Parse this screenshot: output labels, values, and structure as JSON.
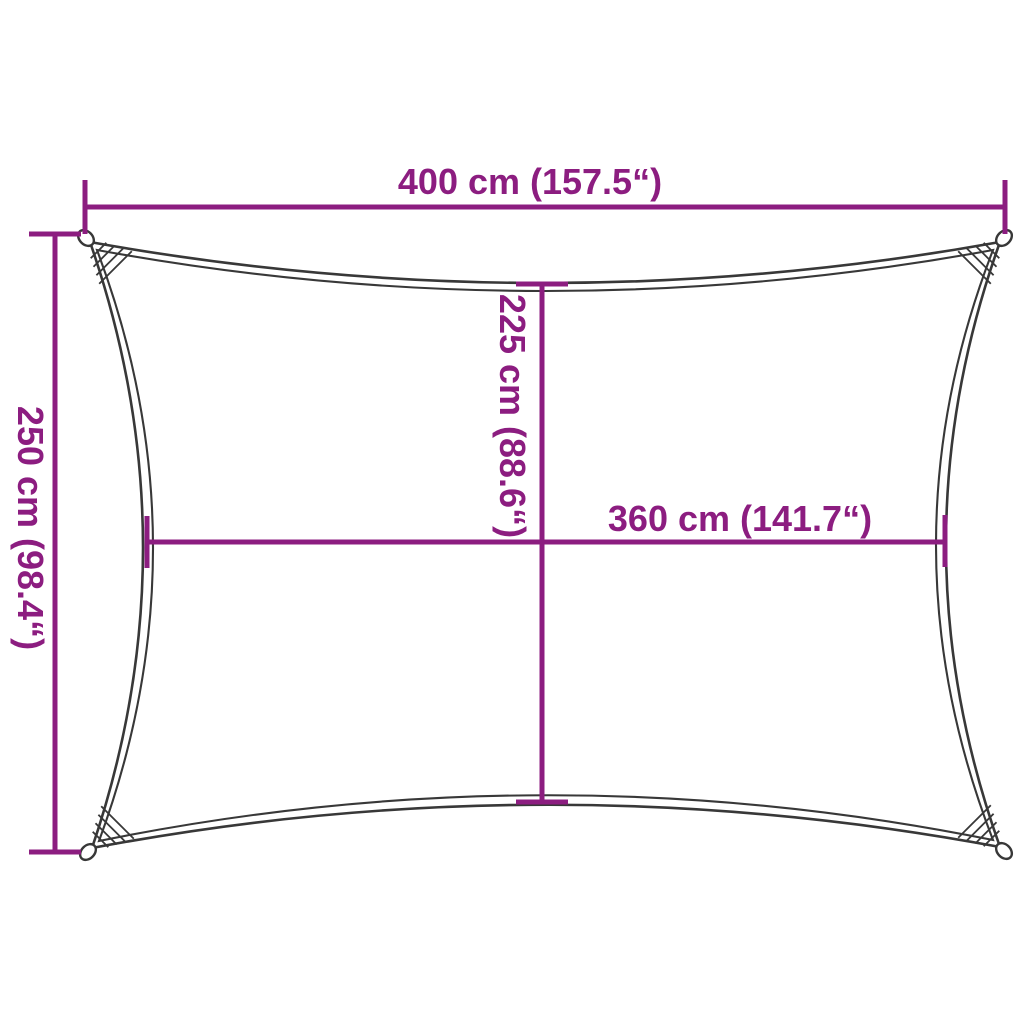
{
  "diagram": {
    "title": "shade-sail-dimension-diagram",
    "subject": "rectangular shade sail with concave edges and corner reinforcement rings",
    "colors": {
      "dimension_lines": "#8C1D80",
      "sail_outline": "#383838",
      "background": "#ffffff"
    },
    "dimensions": {
      "top_width": {
        "label": "400 cm (157.5“)",
        "orientation": "horizontal"
      },
      "side_height": {
        "label": "250 cm (98.4“)",
        "orientation": "vertical"
      },
      "center_height": {
        "label": "225 cm (88.6“)",
        "orientation": "vertical"
      },
      "center_width": {
        "label": "360 cm (141.7“)",
        "orientation": "horizontal"
      }
    }
  }
}
